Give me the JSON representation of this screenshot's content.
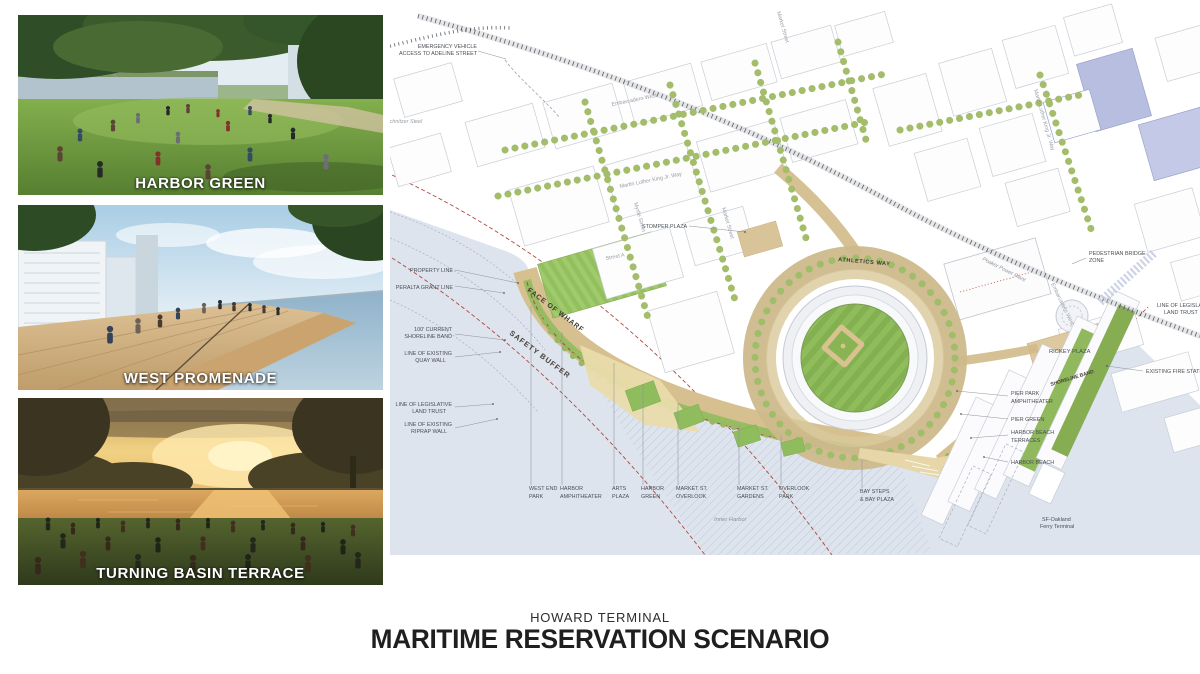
{
  "board": {
    "subtitle": "HOWARD TERMINAL",
    "title": "MARITIME RESERVATION SCENARIO"
  },
  "renders": [
    {
      "caption": "HARBOR GREEN"
    },
    {
      "caption": "WEST PROMENADE"
    },
    {
      "caption": "TURNING BASIN TERRACE"
    }
  ],
  "colors": {
    "label": "#4a4f55",
    "street": "#979da6",
    "bold_label": "#3f3a30",
    "accent_red": "#b0493f",
    "water": "#dde4ee",
    "park_green": "#8fbc5c",
    "esplanade_tan": "#d7c090"
  },
  "site_plan": {
    "caption": "SITE PLAN",
    "labels": [
      {
        "text": "EMERGENCY VEHICLE",
        "x": 477,
        "y": 48,
        "anchor": "end",
        "name": "label-emergency-access"
      },
      {
        "text": "ACCESS TO ADELINE STREET",
        "x": 477,
        "y": 55,
        "anchor": "end",
        "name": "label-emergency-access-2"
      },
      {
        "text": "Schnitzer Steel",
        "x": 386,
        "y": 123,
        "italic": true,
        "color": "#979da6",
        "name": "label-schnitzer-steel"
      },
      {
        "text": "Embarcadero West",
        "x": 612,
        "y": 106,
        "rot": -11.5,
        "color": "#979da6",
        "name": "label-embarcadero-west"
      },
      {
        "text": "Martin Luther King Jr. Way",
        "x": 620,
        "y": 188,
        "rot": -11.5,
        "color": "#979da6",
        "name": "label-mlk-way"
      },
      {
        "text": "Myrtle Street",
        "x": 634,
        "y": 203,
        "rot": 74,
        "color": "#979da6",
        "name": "label-myrtle-street"
      },
      {
        "text": "Market Street",
        "x": 722,
        "y": 208,
        "rot": 74,
        "color": "#979da6",
        "name": "label-market-street"
      },
      {
        "text": "Market Street",
        "x": 777,
        "y": 12,
        "rot": 74,
        "color": "#979da6",
        "name": "label-market-street-north"
      },
      {
        "text": "Martin Luther King Jr. Way",
        "x": 1034,
        "y": 90,
        "rot": 74,
        "color": "#979da6",
        "name": "label-mlk-way-east"
      },
      {
        "text": "Embarcadero West",
        "x": 1051,
        "y": 284,
        "rot": 64,
        "color": "#979da6",
        "name": "label-embarcadero-west-2"
      },
      {
        "text": "Peaker Power Plant",
        "x": 982,
        "y": 260,
        "rot": 27,
        "italic": true,
        "color": "#8d939b",
        "name": "label-peaker-power-plant"
      },
      {
        "text": "STOMPER PLAZA",
        "x": 642,
        "y": 228,
        "name": "label-stomper-plaza"
      },
      {
        "text": "Street A",
        "x": 606,
        "y": 260,
        "rot": -11,
        "color": "#979da6",
        "name": "label-street-a"
      },
      {
        "text": "ATHLETICS WAY",
        "x": 838,
        "y": 261,
        "rot": 5,
        "bold": true,
        "size": 5.6,
        "ls": 0.6,
        "color": "#3f3a30",
        "name": "label-athletics-way"
      },
      {
        "text": "FACE OF WHARF",
        "x": 527,
        "y": 291,
        "rot": 37,
        "bold": true,
        "size": 7,
        "ls": 0.8,
        "color": "#3f3a30",
        "name": "label-face-of-wharf"
      },
      {
        "text": "SAFETY BUFFER",
        "x": 509,
        "y": 334,
        "rot": 37,
        "bold": true,
        "size": 7.4,
        "ls": 1,
        "color": "#4a4038",
        "name": "label-safety-buffer"
      },
      {
        "text": "PEDESTRIAN BRIDGE",
        "x": 1089,
        "y": 255,
        "name": "label-pedestrian-bridge"
      },
      {
        "text": "ZONE",
        "x": 1089,
        "y": 262,
        "name": "label-pedestrian-bridge-2"
      },
      {
        "text": "LINE OF LEGISLATIVE",
        "x": 1157,
        "y": 307,
        "name": "label-line-legislative-east"
      },
      {
        "text": "LAND TRUST",
        "x": 1164,
        "y": 314,
        "name": "label-line-legislative-east-2"
      },
      {
        "text": "EXISTING FIRE STATION",
        "x": 1146,
        "y": 373,
        "name": "label-existing-fire-station"
      },
      {
        "text": "RICKEY PLAZA",
        "x": 1049,
        "y": 353,
        "size": 5.8,
        "name": "label-rickey-plaza"
      },
      {
        "text": "SHORELINE BAND",
        "x": 1051,
        "y": 386,
        "rot": -17,
        "bold": true,
        "size": 5,
        "color": "#4a4038",
        "name": "label-shoreline-band-east"
      },
      {
        "text": "PROPERTY LINE",
        "x": 453,
        "y": 272,
        "anchor": "end",
        "name": "label-property-line"
      },
      {
        "text": "PERALTA GRANT LINE",
        "x": 453,
        "y": 289,
        "anchor": "end",
        "name": "label-peralta-grant-line"
      },
      {
        "text": "100' CURRENT",
        "x": 452,
        "y": 331,
        "anchor": "end",
        "name": "label-shoreline-band"
      },
      {
        "text": "SHORELINE BAND",
        "x": 452,
        "y": 338,
        "anchor": "end",
        "name": "label-shoreline-band-2"
      },
      {
        "text": "LINE OF EXISTING",
        "x": 452,
        "y": 355,
        "anchor": "end",
        "name": "label-quay-wall"
      },
      {
        "text": "QUAY WALL",
        "x": 446,
        "y": 362,
        "anchor": "end",
        "name": "label-quay-wall-2"
      },
      {
        "text": "LINE OF LEGISLATIVE",
        "x": 452,
        "y": 406,
        "anchor": "end",
        "name": "label-land-trust"
      },
      {
        "text": "LAND TRUST",
        "x": 446,
        "y": 413,
        "anchor": "end",
        "name": "label-land-trust-2"
      },
      {
        "text": "LINE OF EXISTING",
        "x": 452,
        "y": 426,
        "anchor": "end",
        "name": "label-riprap-wall"
      },
      {
        "text": "RIPRAP WALL",
        "x": 447,
        "y": 433,
        "anchor": "end",
        "name": "label-riprap-wall-2"
      },
      {
        "text": "PIER PARK",
        "x": 1011,
        "y": 395,
        "name": "label-pier-park-amphitheater"
      },
      {
        "text": "AMPHITHEATER",
        "x": 1011,
        "y": 403,
        "name": "label-pier-park-amphitheater-2"
      },
      {
        "text": "PIER GREEN",
        "x": 1011,
        "y": 421,
        "name": "label-pier-green"
      },
      {
        "text": "HARBOR BEACH",
        "x": 1011,
        "y": 434,
        "name": "label-harbor-beach-terraces"
      },
      {
        "text": "TERRACES",
        "x": 1011,
        "y": 442,
        "name": "label-harbor-beach-terraces-2"
      },
      {
        "text": "HARBOR BEACH",
        "x": 1011,
        "y": 464,
        "name": "label-harbor-beach"
      },
      {
        "text": "WEST END",
        "x": 529,
        "y": 490,
        "name": "label-west-end-park"
      },
      {
        "text": "PARK",
        "x": 529,
        "y": 498,
        "name": "label-west-end-park-2"
      },
      {
        "text": "HARBOR",
        "x": 560,
        "y": 490,
        "name": "label-harbor-amphitheater"
      },
      {
        "text": "AMPHITHEATER",
        "x": 560,
        "y": 498,
        "name": "label-harbor-amphitheater-2"
      },
      {
        "text": "ARTS",
        "x": 612,
        "y": 490,
        "name": "label-arts-plaza"
      },
      {
        "text": "PLAZA",
        "x": 612,
        "y": 498,
        "name": "label-arts-plaza-2"
      },
      {
        "text": "HARBOR",
        "x": 641,
        "y": 490,
        "name": "label-harbor-green"
      },
      {
        "text": "GREEN",
        "x": 641,
        "y": 498,
        "name": "label-harbor-green-2"
      },
      {
        "text": "MARKET ST.",
        "x": 676,
        "y": 490,
        "name": "label-market-st-overlook"
      },
      {
        "text": "OVERLOOK",
        "x": 676,
        "y": 498,
        "name": "label-market-st-overlook-2"
      },
      {
        "text": "MARKET ST.",
        "x": 737,
        "y": 490,
        "name": "label-market-st-gardens"
      },
      {
        "text": "GARDENS",
        "x": 737,
        "y": 498,
        "name": "label-market-st-gardens-2"
      },
      {
        "text": "OVERLOOK",
        "x": 779,
        "y": 490,
        "name": "label-overlook-park"
      },
      {
        "text": "PARK",
        "x": 779,
        "y": 498,
        "name": "label-overlook-park-2"
      },
      {
        "text": "BAY STEPS",
        "x": 860,
        "y": 493,
        "name": "label-bay-steps"
      },
      {
        "text": "& BAY PLAZA",
        "x": 860,
        "y": 501,
        "name": "label-bay-steps-2"
      },
      {
        "text": "Inner Harbor",
        "x": 714,
        "y": 521,
        "italic": true,
        "size": 5.8,
        "color": "#8d939b",
        "name": "label-inner-harbor"
      },
      {
        "text": "SF-Oakland",
        "x": 1042,
        "y": 521,
        "name": "label-ferry-terminal"
      },
      {
        "text": "Ferry Terminal",
        "x": 1040,
        "y": 528,
        "name": "label-ferry-terminal-2"
      }
    ]
  }
}
